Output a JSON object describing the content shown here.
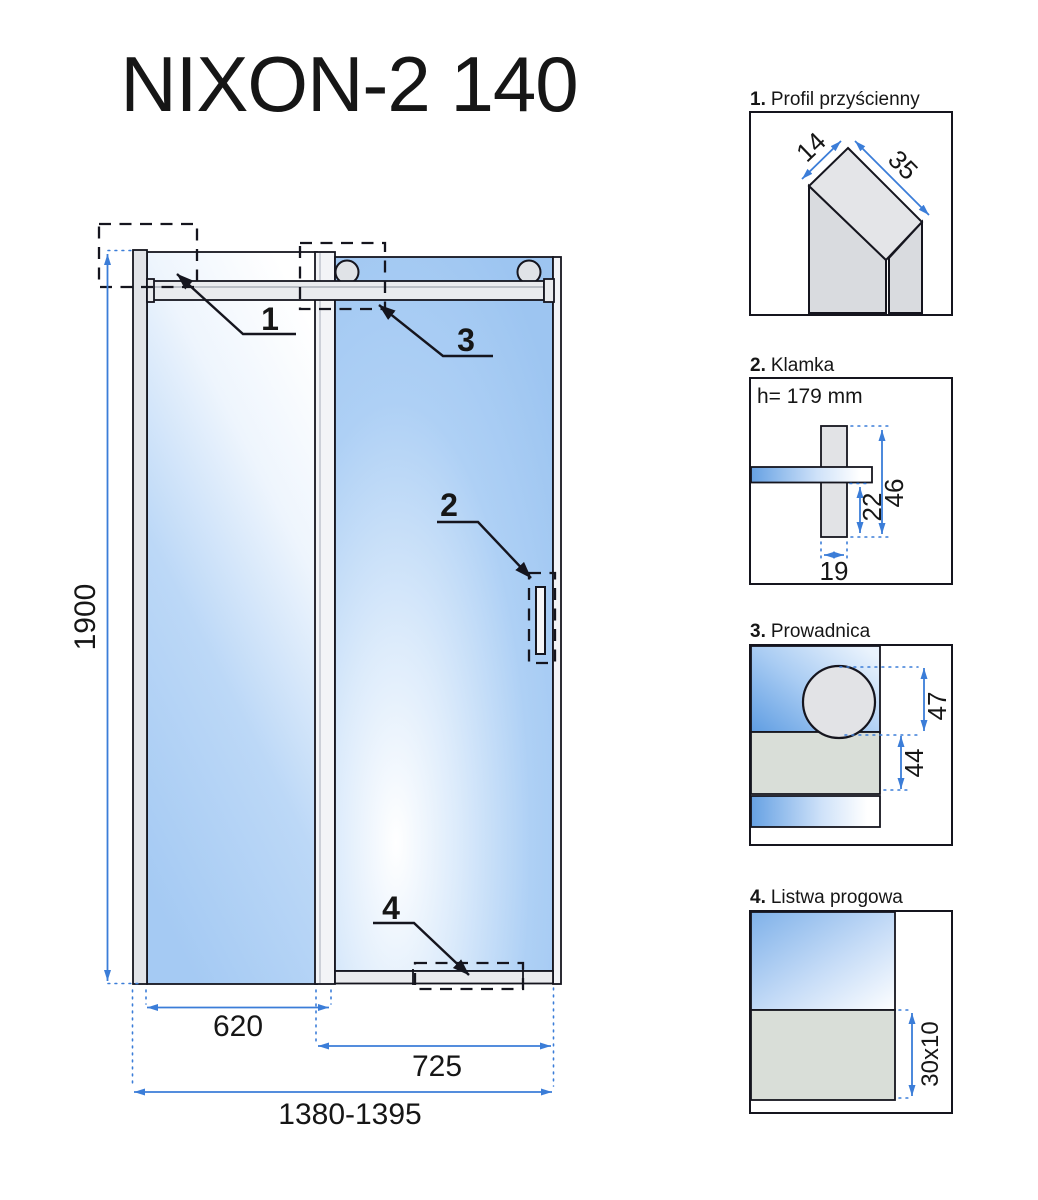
{
  "title": "NIXON-2 140",
  "drawing": {
    "callout_1": "1",
    "callout_2": "2",
    "callout_3": "3",
    "callout_4": "4",
    "dim_height": "1900",
    "dim_fixed_panel_width": "620",
    "dim_door_width": "725",
    "dim_total_width": "1380-1395"
  },
  "panels": [
    {
      "num": "1.",
      "title": "Profil przyścienny",
      "dim_side": "14",
      "dim_face": "35"
    },
    {
      "num": "2.",
      "title": "Klamka",
      "height_note": "h= 179 mm",
      "dim_inner": "22",
      "dim_outer": "46",
      "dim_width": "19"
    },
    {
      "num": "3.",
      "title": "Prowadnica",
      "dim_roller": "47",
      "dim_rail": "44"
    },
    {
      "num": "4.",
      "title": "Listwa progowa",
      "dim_profile": "30x10"
    }
  ],
  "colors": {
    "dimension_blue": "#3b7dd8",
    "outline_dark": "#15151e",
    "glass_blue": "#a5caf3",
    "metal_gray": "#e2e4e8",
    "rail_gray_green": "#d9ded8"
  }
}
